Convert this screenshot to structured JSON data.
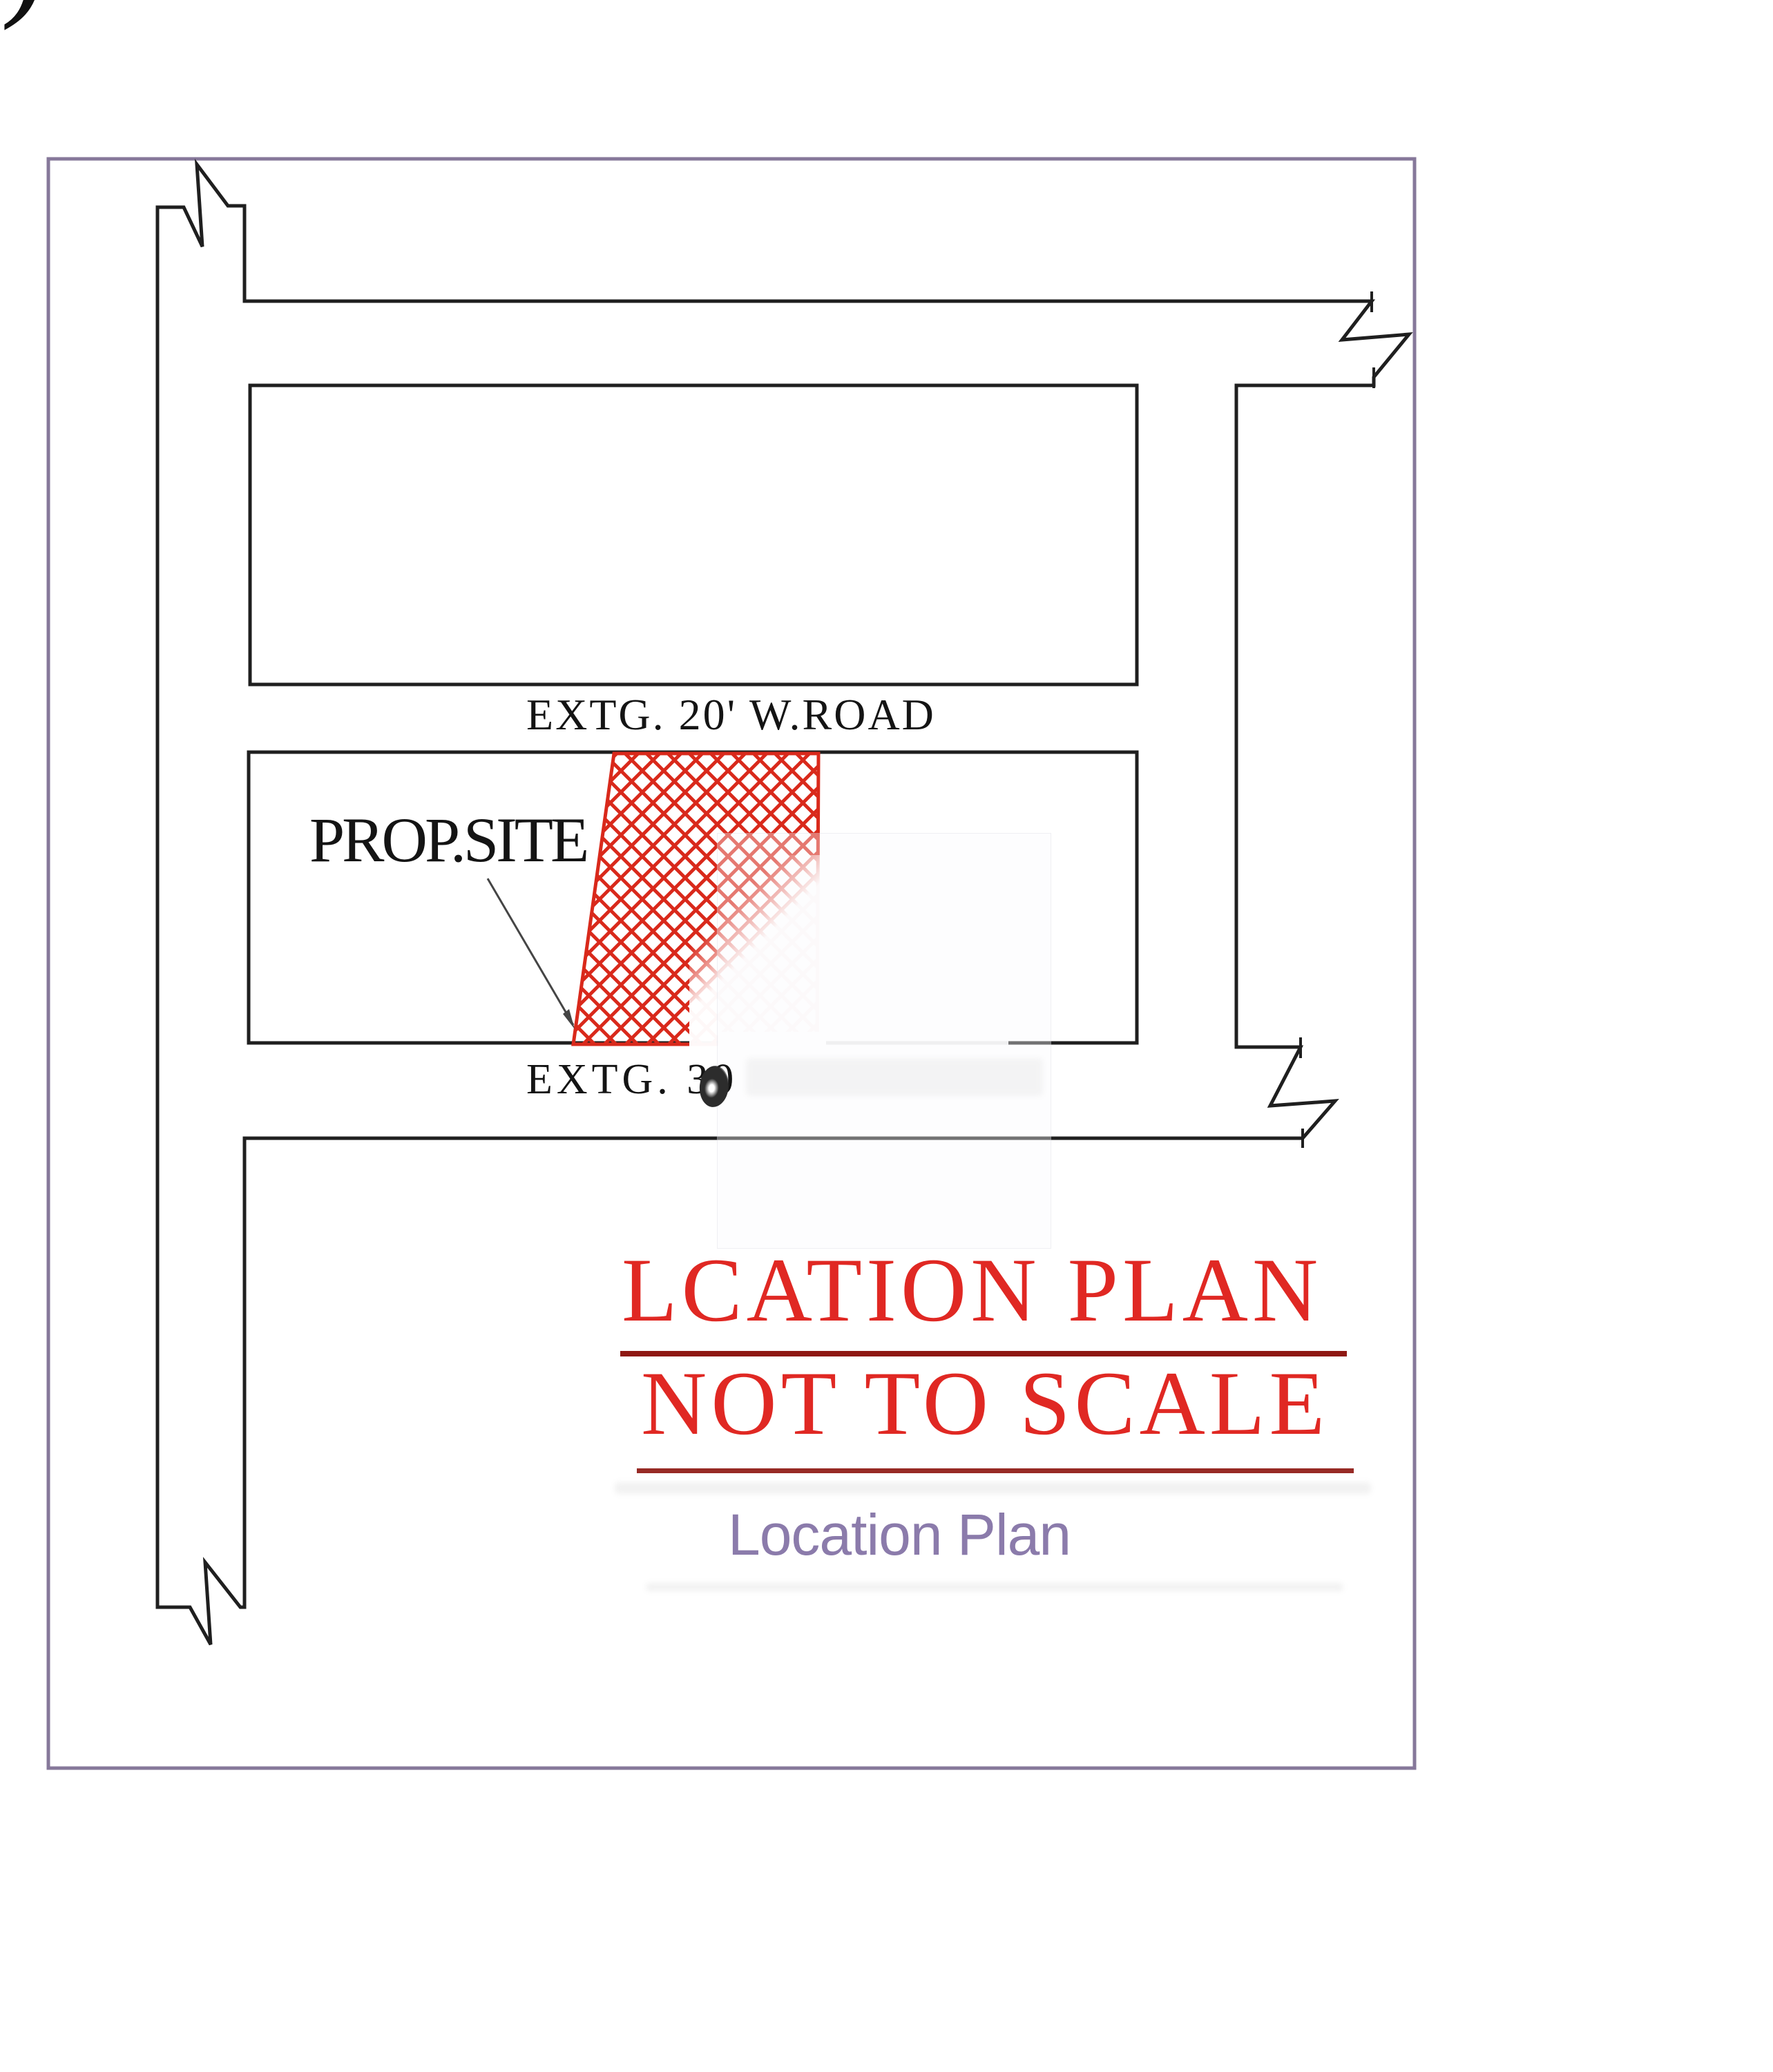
{
  "document": {
    "kind": "site location plan drawing",
    "fragments": {
      "corner_glyph": ")"
    },
    "plan": {
      "road_labels": {
        "middle_road": "EXTG. 20' W.ROAD",
        "bottom_road": "EXTG. 30"
      },
      "site_label": "PROP.SITE",
      "title_line1": "LCATION PLAN",
      "title_line2": "NOT TO SCALE",
      "caption": "Location Plan"
    },
    "colors": {
      "linework": "#1f1f1f",
      "border": "#86789a",
      "hatch_red": "#d9291b",
      "title_red": "#e02823",
      "underline_red": "#8e1812",
      "caption_purple": "#8b7bab",
      "label_black": "#141414"
    }
  }
}
